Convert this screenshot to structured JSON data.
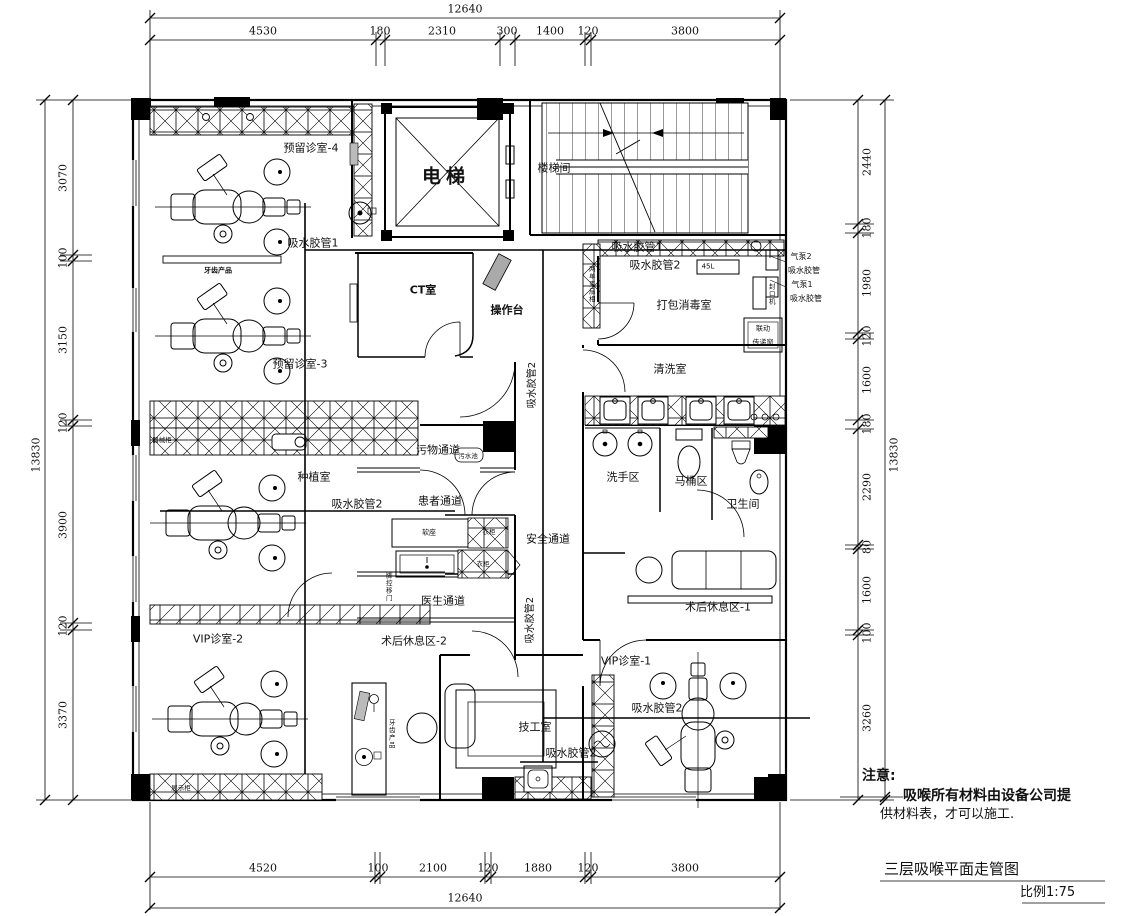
{
  "dims": {
    "top": {
      "total": "12640",
      "segments": [
        "4530",
        "180",
        "2310",
        "300",
        "1400",
        "120",
        "3800"
      ]
    },
    "bottom": {
      "total": "12640",
      "segments": [
        "4520",
        "100",
        "2100",
        "120",
        "1880",
        "120",
        "3800"
      ]
    },
    "left": {
      "total": "13830",
      "segments": [
        "3070",
        "100",
        "3150",
        "120",
        "3900",
        "120",
        "3370"
      ]
    },
    "right": {
      "total": "13830",
      "segments": [
        "2440",
        "180",
        "1980",
        "120",
        "1600",
        "180",
        "2290",
        "80",
        "1600",
        "100",
        "3260"
      ]
    }
  },
  "rooms": {
    "reserved4": "预留诊室-4",
    "reserved3": "预留诊室-3",
    "elevator": "电梯",
    "stairwell": "楼梯间",
    "ct_room": "CT室",
    "console": "操作台",
    "pack_disinfect": "打包消毒室",
    "cleaning": "清洗室",
    "handwash": "洗手区",
    "toilet_zone": "马桶区",
    "bathroom": "卫生间",
    "implant": "种植室",
    "dirty_corridor": "污物通道",
    "patient_corridor": "患者通道",
    "safety_corridor": "安全通道",
    "doctor_corridor": "医生通道",
    "rest2": "术后休息区-2",
    "rest1": "术后休息区-1",
    "vip2": "VIP诊室-2",
    "vip1": "VIP诊室-1",
    "technician": "技工室"
  },
  "pipes": {
    "hose1_a": "吸水胶管1",
    "hose1_b": "吸水胶管1",
    "hose2_a": "吸水胶管2",
    "hose2_b": "吸水胶管2",
    "hose2_c": "吸水胶管2",
    "hose2_d": "吸水胶管2",
    "hose2_e": "吸水胶管2",
    "hose2_f": "吸水胶管2"
  },
  "equipment": {
    "air_pump2": "气泵2",
    "hose_a": "吸水胶管",
    "air_pump1": "气泵1",
    "hose_b": "吸水胶管",
    "tank": "45L",
    "sealer": "封口机",
    "interlock": "联动",
    "pass_window": "传递窗",
    "dental_shelf": "牙齿产品",
    "dental_cabinet": "牙齿产品",
    "soft_seat": "软座",
    "wardrobe_a": "衣柜",
    "wardrobe_b": "衣柜",
    "foot_door": "脚控移门",
    "instrument_cabinet": "器械柜",
    "display_cabinet": "展示柜",
    "mop_sink": "污水池",
    "shaft": "两单束扇相"
  },
  "notes": {
    "attention": "注意:",
    "line1": "吸喉所有材料由设备公司提",
    "line2": "供材料表，才可以施工.",
    "drawing_title": "三层吸喉平面走管图",
    "scale": "比例1:75"
  }
}
